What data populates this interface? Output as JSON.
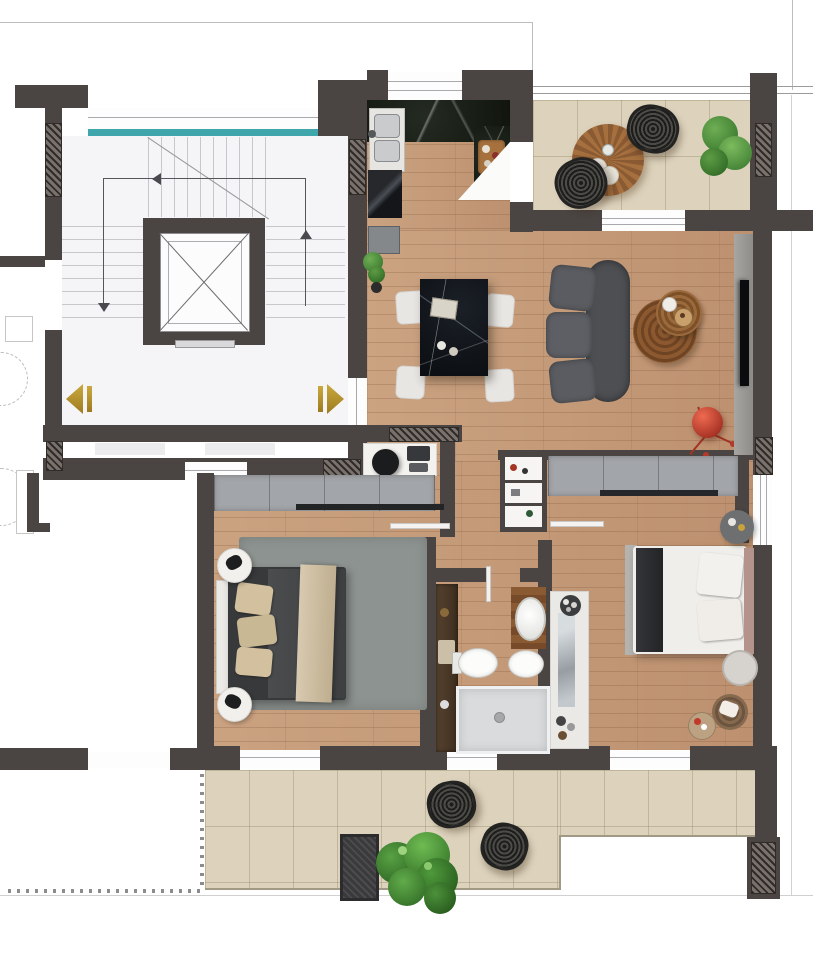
{
  "document": {
    "type": "architectural floor plan",
    "style": "top-down furnished 3D render, no text labels",
    "canvas": {
      "width": 813,
      "height": 960
    }
  },
  "palette": {
    "wall_dark": "#4a4442",
    "wood_floor": "#c69d7c",
    "terrace_tile": "#ddd3bd",
    "stairhall_floor": "#f5f5f7",
    "window_teal": "#3fa6ac",
    "entrance_marker_gold": "#b3882a",
    "black_marble": "#0e1115",
    "counter_marble": "#161b14",
    "sofa_gray": "#55575b",
    "wardrobe_gray": "#a2a5a9",
    "lamp_red": "#c43a28",
    "plant_green": "#3f8c33",
    "rug_gray_green": "#8d9390"
  },
  "areas": {
    "stairwell_common": {
      "features": [
        "elevator-shaft-with-x-cross",
        "three-stair-flights",
        "walk-path-arrows",
        "teal-window-strip",
        "gold-entrance-arrow-left",
        "gold-entrance-arrow-right",
        "landing"
      ]
    },
    "kitchen": {
      "furniture": [
        "dark-marble-counter",
        "double-basin-sink",
        "glossy-black-lower-cabinet",
        "island-slab",
        "wood-cutting-board-with-food",
        "banana",
        "open-door-to-terrace"
      ]
    },
    "terrace_top": {
      "furniture": [
        "round-slatted-wood-table",
        "two-plates",
        "cup",
        "wicker-lounge-chair-x2",
        "potted-plant"
      ],
      "floor": "beige tile",
      "parapet": "thin double line"
    },
    "living_dining": {
      "furniture": [
        "black-marble-dining-table",
        "white-dining-chair-x4",
        "tray-and-cups",
        "curved-gray-sofa-3-seats",
        "nesting-round-coffee-tables-x2",
        "red-tripod-floor-lamp",
        "tv-on-media-panel",
        "small-plant",
        "sideboard",
        "desk-with-office-chair-and-printer"
      ],
      "floor": "wood planks"
    },
    "hallway": {
      "furniture": [
        "display-shelf-niche",
        "open-door-leaf-bedroom1",
        "open-door-leaf-bedroom2"
      ]
    },
    "bedroom_1": {
      "furniture": [
        "gray-wardrobe",
        "rug",
        "double-bed-dark-duvet",
        "beige-pillows-x3",
        "beige-throw",
        "round-nightstand-with-black-lamp-x2"
      ]
    },
    "bathroom": {
      "furniture": [
        "tall-wood-vanity",
        "vessel-sink-on-wood-counter",
        "toilet",
        "bidet",
        "walk-in-shower"
      ]
    },
    "bedroom_2": {
      "furniture": [
        "gray-wardrobe",
        "double-bed-white-duvet",
        "dark-foot-throw",
        "pillow-x2",
        "round-nightstand-x2",
        "wicker-basket",
        "tray-with-items",
        "dresser-with-mirror"
      ]
    },
    "terrace_bottom": {
      "furniture": [
        "wicker-chair-x2",
        "dark-slatted-mat",
        "large-potted-plant"
      ],
      "railing": "baluster dots along left edge and neighbour edge",
      "floor": "beige tile, stepped outline"
    },
    "counts": {
      "dining_chairs": 4,
      "wicker_chairs_total": 4,
      "bedrooms": 2,
      "terraces": 2,
      "coffee_tables": 2,
      "nightstands": 4
    }
  }
}
